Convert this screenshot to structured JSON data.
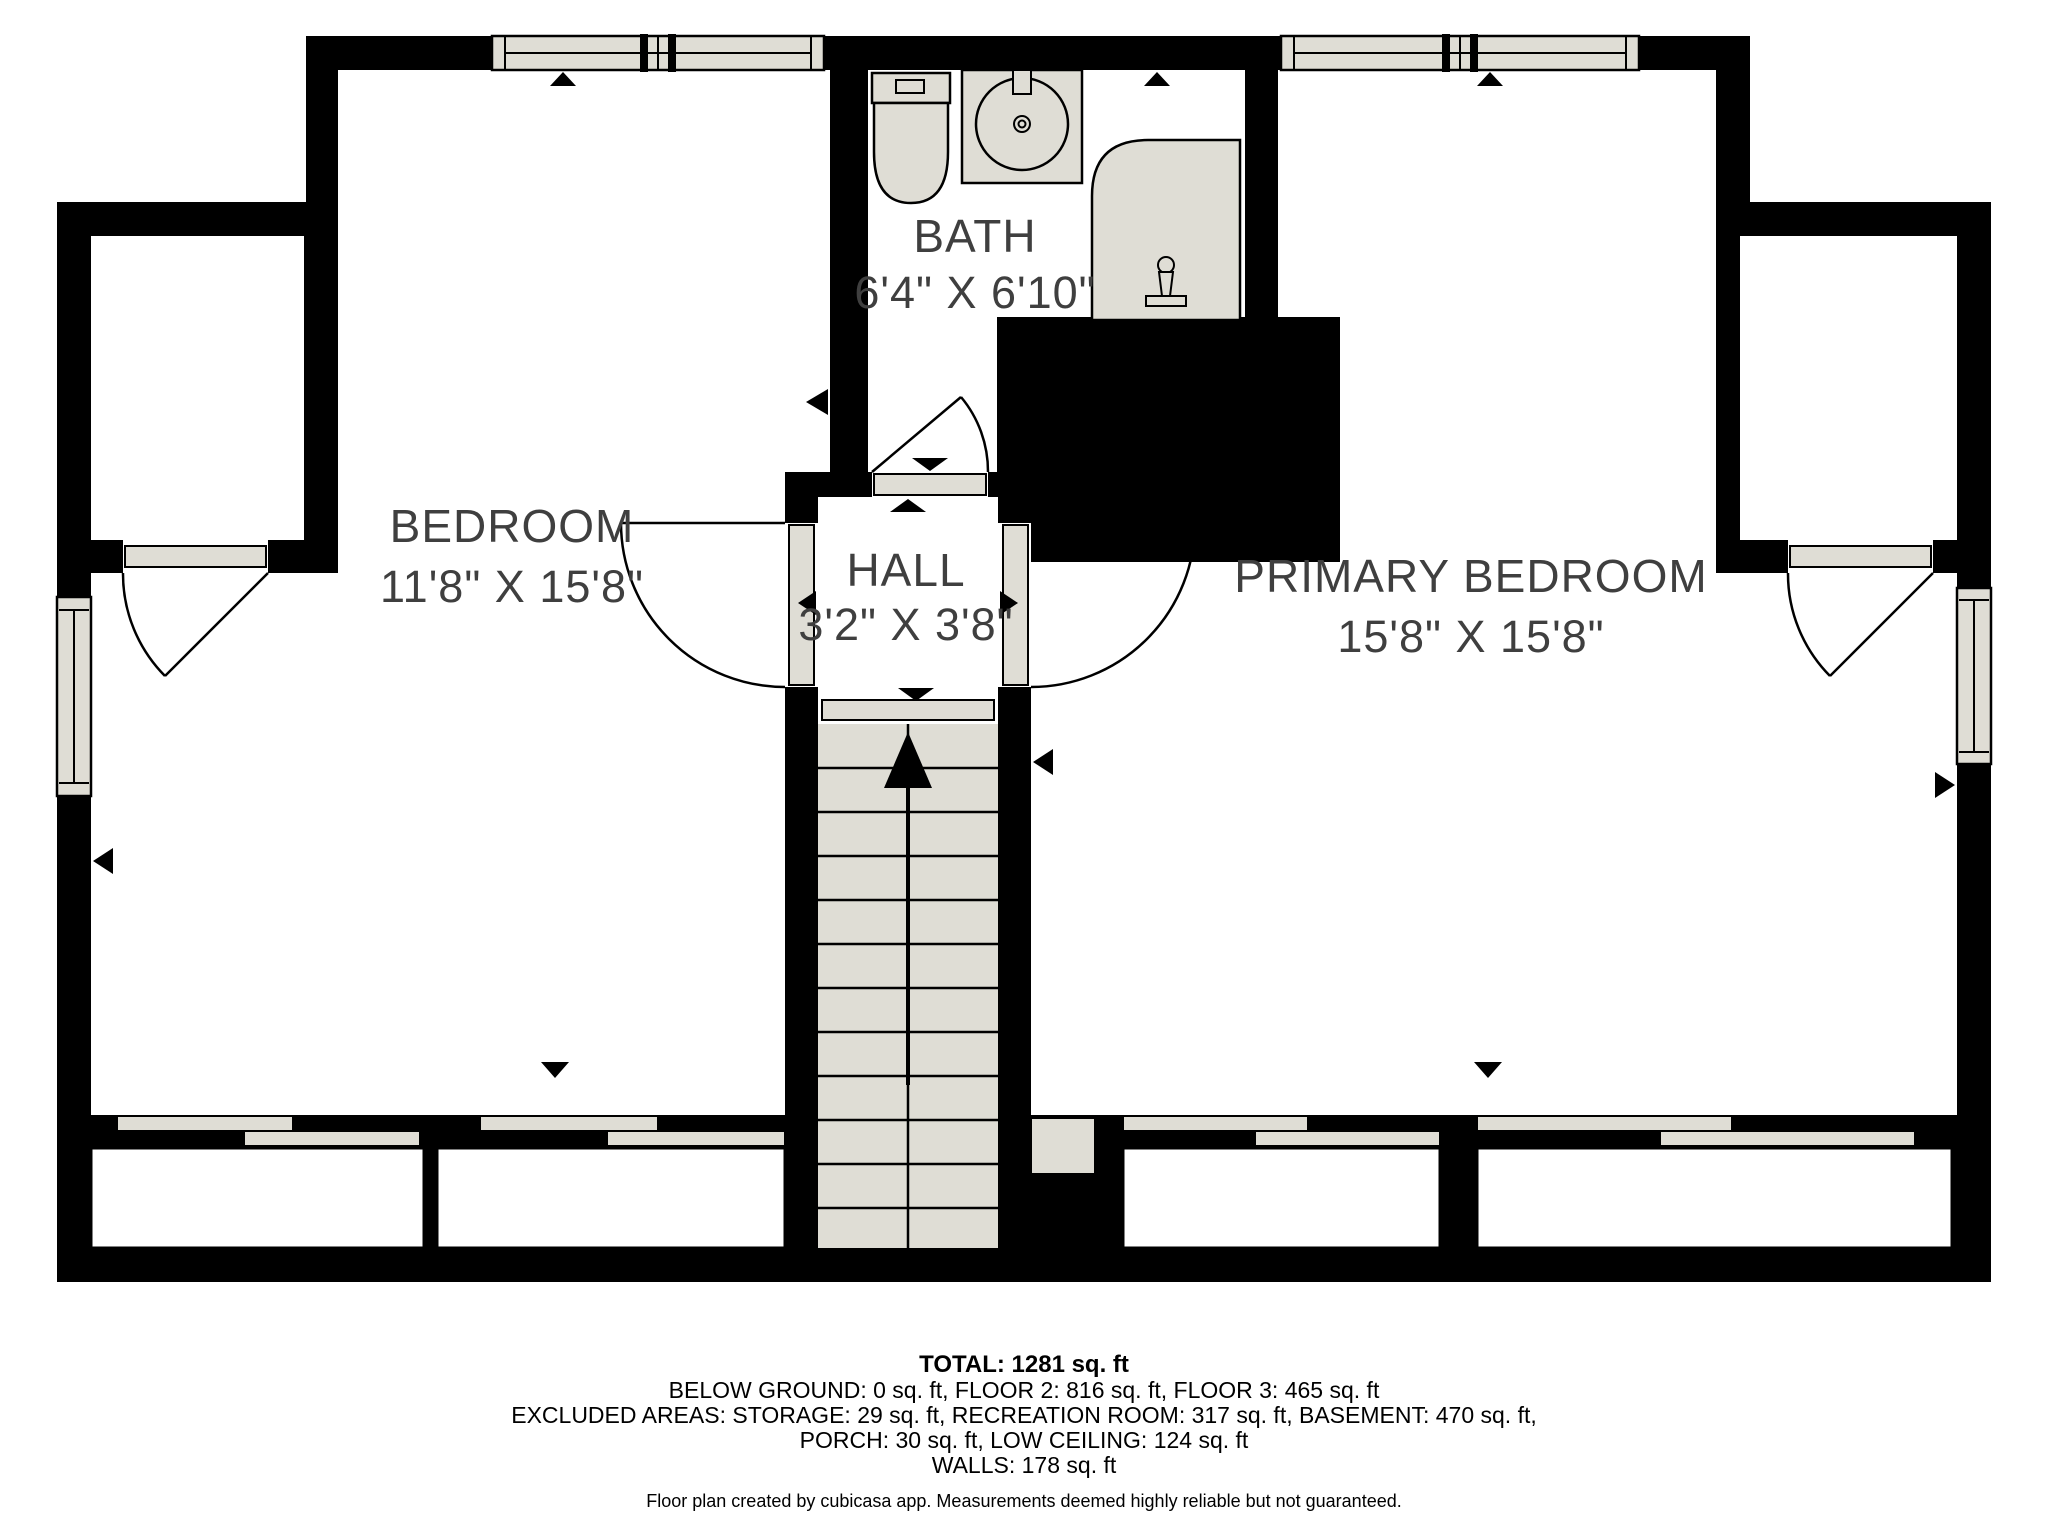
{
  "plan": {
    "type": "floor-plan",
    "rooms": [
      {
        "name": "BEDROOM",
        "dims": "11'8\" X 15'8\""
      },
      {
        "name": "BATH",
        "dims": "6'4\" X 6'10\""
      },
      {
        "name": "HALL",
        "dims": "3'2\" X 3'8\""
      },
      {
        "name": "PRIMARY BEDROOM",
        "dims": "15'8\" X 15'8\""
      }
    ],
    "fixtures": [
      "toilet",
      "sink",
      "shower",
      "stairs-up-arrow",
      "door-swing",
      "window"
    ],
    "colors": {
      "wall": "#000000",
      "floor": "#ffffff",
      "fixture_gray": "#dfddd5",
      "label_gray": "#3f3f3f"
    }
  },
  "footer": {
    "total": "TOTAL: 1281 sq. ft",
    "line2": "BELOW GROUND: 0 sq. ft, FLOOR 2: 816 sq. ft, FLOOR 3: 465 sq. ft",
    "line3": "EXCLUDED AREAS: STORAGE: 29 sq. ft, RECREATION ROOM: 317 sq. ft, BASEMENT: 470 sq. ft,",
    "line4": "PORCH: 30 sq. ft, LOW CEILING: 124 sq. ft",
    "line5": "WALLS: 178 sq. ft",
    "disclaimer": "Floor plan created by cubicasa app. Measurements deemed highly reliable but not guaranteed."
  }
}
